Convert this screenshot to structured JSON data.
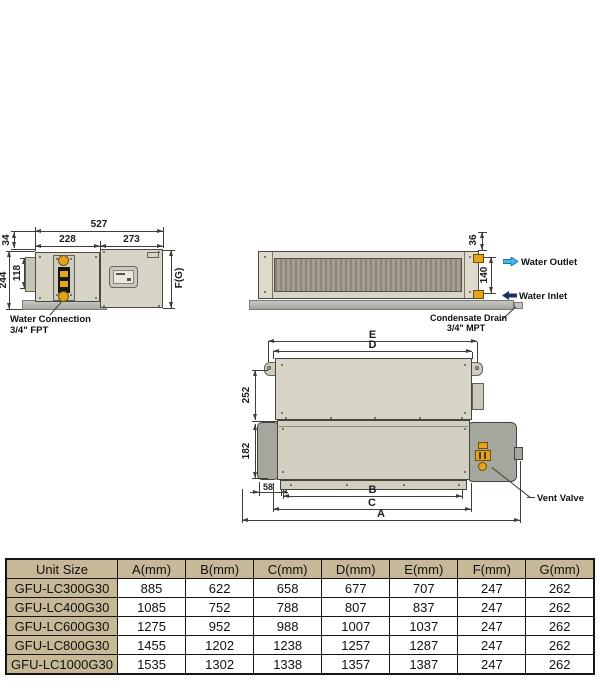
{
  "side_view": {
    "dim_total_width": "527",
    "dim_left_width": "228",
    "dim_right_width": "273",
    "dim_top_offset": "34",
    "dim_total_height": "244",
    "dim_inner_height": "118",
    "dim_height_ref": "F(G)",
    "water_connection_line1": "Water Connection",
    "water_connection_line2": "3/4\" FPT"
  },
  "front_view": {
    "dim_top_clearance": "36",
    "dim_port_spacing": "140",
    "water_outlet_label": "Water Outlet",
    "water_inlet_label": "Water Inlet",
    "condensate_line1": "Condensate Drain",
    "condensate_line2": "3/4\" MPT"
  },
  "plan_view": {
    "dim_e": "E",
    "dim_d": "D",
    "dim_b": "B",
    "dim_c": "C",
    "dim_a": "A",
    "dim_depth_upper": "252",
    "dim_depth_lower": "182",
    "dim_end_offset": "58",
    "vent_valve_label": "Vent Valve"
  },
  "table": {
    "headers": [
      "Unit Size",
      "A(mm)",
      "B(mm)",
      "C(mm)",
      "D(mm)",
      "E(mm)",
      "F(mm)",
      "G(mm)"
    ],
    "rows": [
      [
        "GFU-LC300G30",
        "885",
        "622",
        "658",
        "677",
        "707",
        "247",
        "262"
      ],
      [
        "GFU-LC400G30",
        "1085",
        "752",
        "788",
        "807",
        "837",
        "247",
        "262"
      ],
      [
        "GFU-LC600G30",
        "1275",
        "952",
        "988",
        "1007",
        "1037",
        "247",
        "262"
      ],
      [
        "GFU-LC800G30",
        "1455",
        "1202",
        "1238",
        "1257",
        "1287",
        "247",
        "262"
      ],
      [
        "GFU-LC1000G30",
        "1535",
        "1302",
        "1338",
        "1357",
        "1387",
        "247",
        "262"
      ]
    ]
  },
  "colors": {
    "line": "#3f3f39",
    "unit_body": "#d9d5c6",
    "unit_body_dark": "#d3cfc0",
    "end_cap": "#dedacc",
    "metal_gray": "#b7b8b2",
    "compartment_gray": "#a5a79f",
    "fitting_yellow": "#e2a31d",
    "outlet_cyan": "#45b8e8",
    "inlet_navy": "#1d2f6d",
    "table_tan": "#c7b997"
  }
}
